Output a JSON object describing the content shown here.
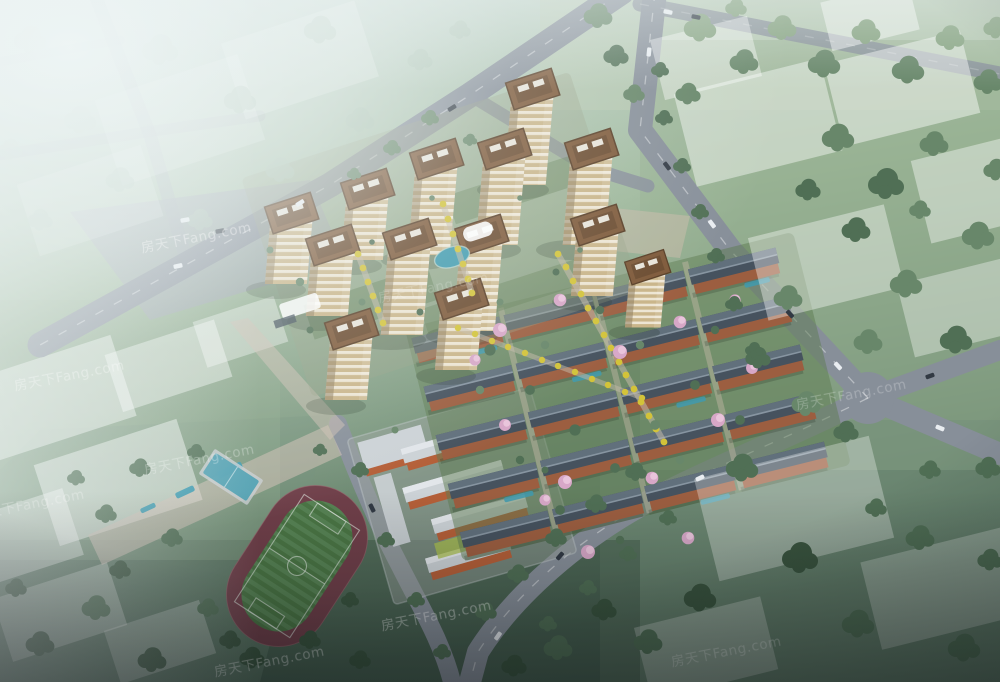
{
  "meta": {
    "type": "architectural aerial rendering",
    "subject": "bird's-eye view of a residential development masterplan"
  },
  "watermark": {
    "text": "房天下Fang.com",
    "brand": "Fang.com"
  },
  "scene": {
    "elements": [
      "high-rise residential towers",
      "townhouse rows with courtyard gardens",
      "central landscaped axes with yellow trees",
      "central pond",
      "school campus with red buildings",
      "running track with soccer field",
      "outdoor courts and linear park pools",
      "tree-lined roads with cars",
      "hazy white city-context blocks"
    ],
    "tower_count": 13,
    "townhouse_row_count": 20
  },
  "palette": {
    "bgTop": "#c9dad4",
    "bgMid": "#9db79a",
    "bgLow": "#7b977e",
    "bgBottom": "#4c6756",
    "grassLight": "#b9cbb2",
    "grassMid": "#93ad8d",
    "grassDeep": "#74907a",
    "grassDark": "#3f5847",
    "treeHaze": "#a8bfae",
    "tree1": "#86a381",
    "tree2": "#68876a",
    "tree3": "#506f55",
    "tree4": "#3a553f",
    "road": "#878f99",
    "roadFaint": "#9ba3ab",
    "pave": "#c3b9a7",
    "paveAxis": "#cfbfb4",
    "towerTan": "#c9b488",
    "towerStripe": "#ede5d3",
    "towerShade": "#8d7c5c",
    "towerBrown": "#7d5838",
    "towerBrownDark": "#573c24",
    "roofSlate": "#46525e",
    "roofSlateLight": "#61707c",
    "ridge": "#8795a1",
    "terracotta": "#9c5e40",
    "garden": "#5e7c52",
    "schoolRed": "#b45f38",
    "schoolRoof": "#ccd2d6",
    "schoolGround": "#9aa29e",
    "trackRed": "#6f3f49",
    "field": "#4a7544",
    "fieldStripe": "#578354",
    "water": "#3f9aae",
    "yellowTree": "#d3c339",
    "blossom": "#d7a7c7",
    "blossomLight": "#ecc9de",
    "shadow": "#1f2d1e",
    "carLight": "#e9edf1",
    "carDark": "#323a44"
  }
}
